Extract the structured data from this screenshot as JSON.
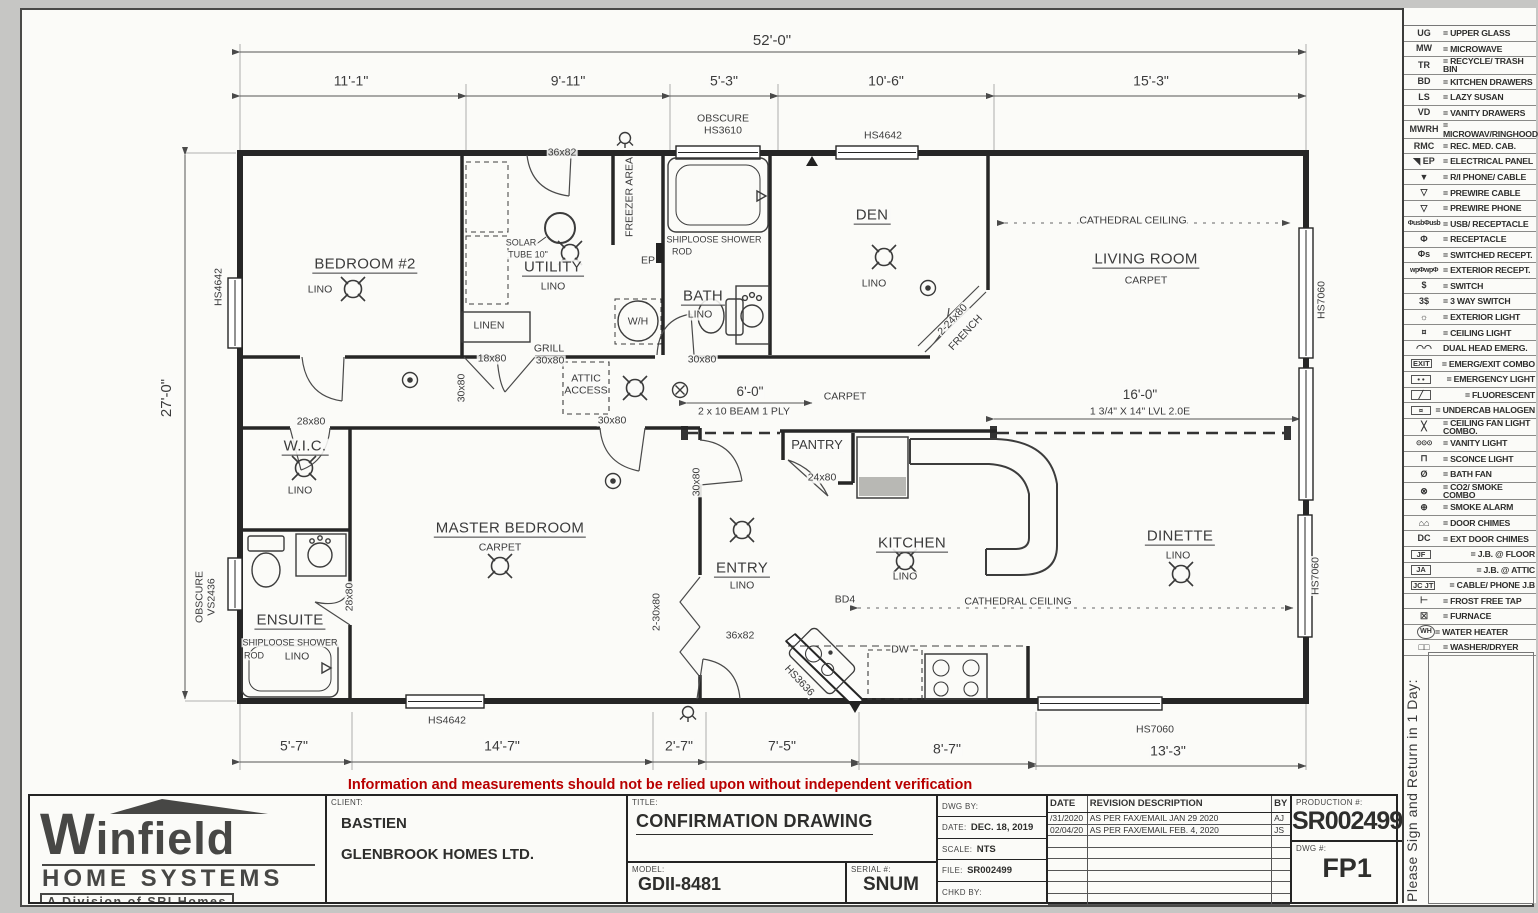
{
  "disclaimer": "Information and measurements should not be relied upon without independent verification",
  "sign_notice": "Please Sign and Return in 1 Day:",
  "legend": {
    "items": [
      {
        "sym": "UG",
        "label": "= UPPER GLASS",
        "icon": "upper-glass"
      },
      {
        "sym": "MW",
        "label": "= MICROWAVE",
        "icon": "microwave"
      },
      {
        "sym": "TR",
        "label": "= RECYCLE/ TRASH BIN",
        "icon": "recycle-trash-bin"
      },
      {
        "sym": "BD",
        "label": "= KITCHEN DRAWERS",
        "icon": "kitchen-drawers"
      },
      {
        "sym": "LS",
        "label": "= LAZY SUSAN",
        "icon": "lazy-susan"
      },
      {
        "sym": "VD",
        "label": "= VANITY DRAWERS",
        "icon": "vanity-drawers"
      },
      {
        "sym": "MWRH",
        "label": "= MICROWAV/RINGHOOD",
        "icon": "microwave-rangehood"
      },
      {
        "sym": "RMC",
        "label": "= REC. MED. CAB.",
        "icon": "recessed-medicine-cabinet"
      },
      {
        "sym": "◥ EP",
        "label": "= ELECTRICAL PANEL",
        "icon": "electrical-panel"
      },
      {
        "sym": "▼",
        "label": "= R/I PHONE/ CABLE",
        "icon": "phone-cable-rough-in"
      },
      {
        "sym": "▽",
        "label": "= PREWIRE CABLE",
        "icon": "prewire-cable"
      },
      {
        "sym": "▽",
        "label": "= PREWIRE PHONE",
        "icon": "prewire-phone"
      },
      {
        "sym": "ΦusbΦusb",
        "label": "= USB/ RECEPTACLE",
        "icon": "usb-receptacle",
        "style": "tiny"
      },
      {
        "sym": "Φ",
        "label": "= RECEPTACLE",
        "icon": "receptacle"
      },
      {
        "sym": "Φs",
        "label": "= SWITCHED RECEPT.",
        "icon": "switched-receptacle"
      },
      {
        "sym": "wpΦwpΦ",
        "label": "= EXTERIOR RECEPT.",
        "icon": "exterior-receptacle",
        "style": "tiny"
      },
      {
        "sym": "$",
        "label": "= SWITCH",
        "icon": "switch"
      },
      {
        "sym": "3$",
        "label": "= 3 WAY SWITCH",
        "icon": "three-way-switch"
      },
      {
        "sym": "☼",
        "label": "= EXTERIOR LIGHT",
        "icon": "exterior-light"
      },
      {
        "sym": "¤",
        "label": "= CEILING LIGHT",
        "icon": "ceiling-light"
      },
      {
        "sym": "◠◠",
        "label": "DUAL HEAD EMERG.",
        "icon": "dual-head-emergency-light"
      },
      {
        "sym": "EXIT",
        "label": "= EMERG/EXIT COMBO",
        "icon": "emergency-exit-combo",
        "style": "box"
      },
      {
        "sym": "• •",
        "label": "= EMERGENCY LIGHT",
        "icon": "emergency-light",
        "style": "box"
      },
      {
        "sym": "╱",
        "label": "= FLUORESCENT",
        "icon": "fluorescent-light",
        "style": "box"
      },
      {
        "sym": "¤",
        "label": "= UNDERCAB HALOGEN",
        "icon": "undercabinet-halogen",
        "style": "box"
      },
      {
        "sym": "╳",
        "label": "= CEILING FAN LIGHT COMBO.",
        "icon": "ceiling-fan-light-combo"
      },
      {
        "sym": "⊙⊙⊙",
        "label": "= VANITY LIGHT",
        "icon": "vanity-light",
        "style": "tiny"
      },
      {
        "sym": "⊓",
        "label": "= SCONCE LIGHT",
        "icon": "sconce-light"
      },
      {
        "sym": "Ø",
        "label": "= BATH FAN",
        "icon": "bath-fan"
      },
      {
        "sym": "⊗",
        "label": "= CO2/ SMOKE COMBO",
        "icon": "co2-smoke-combo"
      },
      {
        "sym": "⊕",
        "label": "= SMOKE ALARM",
        "icon": "smoke-alarm"
      },
      {
        "sym": "⌂⌂",
        "label": "= DOOR CHIMES",
        "icon": "door-chimes"
      },
      {
        "sym": "DC",
        "label": "= EXT DOOR CHIMES",
        "icon": "exterior-door-chimes"
      },
      {
        "sym": "JF",
        "label": "= J.B. @ FLOOR",
        "icon": "junction-box-floor",
        "style": "box"
      },
      {
        "sym": "JA",
        "label": "= J.B. @ ATTIC",
        "icon": "junction-box-attic",
        "style": "box"
      },
      {
        "sym": "JC JT",
        "label": "= CABLE/ PHONE J.B",
        "icon": "cable-phone-junction-box",
        "style": "box"
      },
      {
        "sym": "⊢",
        "label": "= FROST FREE TAP",
        "icon": "frost-free-tap"
      },
      {
        "sym": "☒",
        "label": "= FURNACE",
        "icon": "furnace"
      },
      {
        "sym": "WH",
        "label": "= WATER HEATER",
        "icon": "water-heater",
        "style": "circle"
      },
      {
        "sym": "□□",
        "label": "= WASHER/DRYER",
        "icon": "washer-dryer"
      }
    ]
  },
  "title_block": {
    "logo_name": "Winfield",
    "logo_line2": "HOME SYSTEMS",
    "logo_line3": "A Division of SRI Homes",
    "client_label": "CLIENT:",
    "client_name": "BASTIEN",
    "client_company": "GLENBROOK HOMES LTD.",
    "title_label": "TITLE:",
    "title": "CONFIRMATION DRAWING",
    "model_label": "MODEL:",
    "model": "GDII-8481",
    "serial_label": "SERIAL #:",
    "serial": "SNUM",
    "dwg_by_label": "DWG BY:",
    "dwg_by": "JSIOPONGCO",
    "date_label": "DATE:",
    "date": "DEC. 18, 2019",
    "scale_label": "SCALE:",
    "scale": "NTS",
    "file_label": "FILE:",
    "file": "SR002499",
    "chkd_label": "CHKD BY:",
    "revisions": {
      "headers": [
        "DATE",
        "REVISION DESCRIPTION",
        "BY"
      ],
      "rows": [
        [
          "/31/2020",
          "AS PER FAX/EMAIL  JAN 29 2020",
          "AJ"
        ],
        [
          "02/04/20",
          "AS PER FAX/EMAIL  FEB. 4, 2020",
          "JS"
        ]
      ]
    },
    "production_label": "PRODUCTION #:",
    "production": "SR002499",
    "dwg_no_label": "DWG #:",
    "dwg_no": "FP1"
  },
  "plan": {
    "dimensions": {
      "overall_width": "52'-0\"",
      "overall_depth": "27'-0\"",
      "top": [
        "11'-1\"",
        "9'-11\"",
        "5'-3\"",
        "10'-6\"",
        "15'-3\""
      ],
      "bottom": [
        "5'-7\"",
        "14'-7\"",
        "2'-7\"",
        "7'-5\"",
        "8'-7\"",
        "13'-3\""
      ]
    },
    "rooms": [
      {
        "name": "BEDROOM #2",
        "floor": "LINO"
      },
      {
        "name": "UTILITY",
        "floor": "LINO"
      },
      {
        "name": "BATH",
        "floor": "LINO"
      },
      {
        "name": "DEN",
        "floor": "LINO"
      },
      {
        "name": "LIVING ROOM",
        "floor": "CARPET"
      },
      {
        "name": "W.I.C.",
        "floor": "LINO"
      },
      {
        "name": "MASTER BEDROOM",
        "floor": "CARPET"
      },
      {
        "name": "ENSUITE",
        "floor": "LINO"
      },
      {
        "name": "ENTRY",
        "floor": "LINO"
      },
      {
        "name": "KITCHEN",
        "floor": "LINO"
      },
      {
        "name": "DINETTE",
        "floor": "LINO"
      },
      {
        "name": "PANTRY",
        "floor": ""
      }
    ],
    "labels": [
      {
        "t": "52'-0\"",
        "x": 772,
        "y": 41,
        "c": "dimL",
        "n": "dim-top-overall"
      },
      {
        "t": "11'-1\"",
        "x": 351,
        "y": 81,
        "c": "dim"
      },
      {
        "t": "9'-11\"",
        "x": 568,
        "y": 81,
        "c": "dim"
      },
      {
        "t": "5'-3\"",
        "x": 724,
        "y": 81,
        "c": "dim"
      },
      {
        "t": "10'-6\"",
        "x": 886,
        "y": 81,
        "c": "dim"
      },
      {
        "t": "15'-3\"",
        "x": 1151,
        "y": 81,
        "c": "dim"
      },
      {
        "t": "27'-0\"",
        "x": 167,
        "y": 398,
        "c": "dimL",
        "r": -90,
        "n": "dim-left-overall"
      },
      {
        "t": "5'-7\"",
        "x": 294,
        "y": 746,
        "c": "dim"
      },
      {
        "t": "14'-7\"",
        "x": 502,
        "y": 746,
        "c": "dim"
      },
      {
        "t": "2'-7\"",
        "x": 679,
        "y": 746,
        "c": "dim"
      },
      {
        "t": "7'-5\"",
        "x": 782,
        "y": 746,
        "c": "dim"
      },
      {
        "t": "8'-7\"",
        "x": 947,
        "y": 749,
        "c": "dim"
      },
      {
        "t": "13'-3\"",
        "x": 1168,
        "y": 751,
        "c": "dim"
      },
      {
        "t": "6'-0\"",
        "x": 750,
        "y": 392,
        "c": "dim2"
      },
      {
        "t": "2 x 10 BEAM 1 PLY",
        "x": 744,
        "y": 412,
        "c": "sm"
      },
      {
        "t": "16'-0\"",
        "x": 1140,
        "y": 395,
        "c": "dim2"
      },
      {
        "t": "1 3/4\" X 14\" LVL 2.0E",
        "x": 1140,
        "y": 412,
        "c": "sm"
      },
      {
        "t": "HS4642",
        "x": 219,
        "y": 287,
        "c": "sm",
        "r": -90
      },
      {
        "t": "OBSCURE",
        "x": 723,
        "y": 119,
        "c": "sm"
      },
      {
        "t": "HS3610",
        "x": 723,
        "y": 131,
        "c": "sm"
      },
      {
        "t": "HS4642",
        "x": 883,
        "y": 136,
        "c": "sm"
      },
      {
        "t": "HS7060",
        "x": 1322,
        "y": 300,
        "c": "sm",
        "r": -90
      },
      {
        "t": "HS7060",
        "x": 1316,
        "y": 576,
        "c": "sm",
        "r": -90
      },
      {
        "t": "OBSCURE",
        "x": 200,
        "y": 597,
        "c": "sm",
        "r": -90
      },
      {
        "t": "VS2436",
        "x": 212,
        "y": 597,
        "c": "sm",
        "r": -90
      },
      {
        "t": "HS3636",
        "x": 799,
        "y": 681,
        "c": "sm",
        "r": 47
      },
      {
        "t": "HS4642",
        "x": 447,
        "y": 721,
        "c": "sm"
      },
      {
        "t": "HS7060",
        "x": 1155,
        "y": 730,
        "c": "sm"
      },
      {
        "t": "36x82",
        "x": 562,
        "y": 153,
        "c": "sm"
      },
      {
        "t": "36x82",
        "x": 740,
        "y": 636,
        "c": "sm"
      },
      {
        "t": "28x80",
        "x": 311,
        "y": 422,
        "c": "sm"
      },
      {
        "t": "28x80",
        "x": 350,
        "y": 597,
        "c": "sm",
        "r": -90
      },
      {
        "t": "30x80",
        "x": 612,
        "y": 421,
        "c": "sm"
      },
      {
        "t": "30x80",
        "x": 697,
        "y": 482,
        "c": "sm",
        "r": -90
      },
      {
        "t": "30x80",
        "x": 702,
        "y": 360,
        "c": "sm"
      },
      {
        "t": "30x80",
        "x": 462,
        "y": 388,
        "c": "sm",
        "r": -90
      },
      {
        "t": "GRILL",
        "x": 549,
        "y": 349,
        "c": "sm"
      },
      {
        "t": "30x80",
        "x": 550,
        "y": 361,
        "c": "sm"
      },
      {
        "t": "18x80",
        "x": 492,
        "y": 359,
        "c": "sm"
      },
      {
        "t": "24x80",
        "x": 822,
        "y": 478,
        "c": "sm"
      },
      {
        "t": "2-30x80",
        "x": 657,
        "y": 612,
        "c": "sm",
        "r": -90
      },
      {
        "t": "2-24x80",
        "x": 953,
        "y": 320,
        "c": "sm",
        "r": -47
      },
      {
        "t": "FRENCH",
        "x": 966,
        "y": 333,
        "c": "sm",
        "r": -47
      },
      {
        "t": "BEDROOM #2",
        "x": 365,
        "y": 265,
        "c": "rt",
        "n": "room-bedroom2"
      },
      {
        "t": "LINO",
        "x": 320,
        "y": 290,
        "c": "sm"
      },
      {
        "t": "UTILITY",
        "x": 553,
        "y": 268,
        "c": "rt",
        "n": "room-utility"
      },
      {
        "t": "LINO",
        "x": 553,
        "y": 287,
        "c": "sm"
      },
      {
        "t": "BATH",
        "x": 703,
        "y": 297,
        "c": "rt",
        "n": "room-bath"
      },
      {
        "t": "LINO",
        "x": 700,
        "y": 315,
        "c": "sm"
      },
      {
        "t": "DEN",
        "x": 872,
        "y": 216,
        "c": "rt",
        "n": "room-den"
      },
      {
        "t": "LINO",
        "x": 874,
        "y": 284,
        "c": "sm"
      },
      {
        "t": "LIVING ROOM",
        "x": 1146,
        "y": 260,
        "c": "rt",
        "n": "room-living-room"
      },
      {
        "t": "CARPET",
        "x": 1146,
        "y": 281,
        "c": "sm"
      },
      {
        "t": "W.I.C.",
        "x": 305,
        "y": 447,
        "c": "rt",
        "n": "room-wic"
      },
      {
        "t": "LINO",
        "x": 300,
        "y": 491,
        "c": "sm"
      },
      {
        "t": "MASTER BEDROOM",
        "x": 510,
        "y": 529,
        "c": "rt",
        "n": "room-master-bedroom"
      },
      {
        "t": "CARPET",
        "x": 500,
        "y": 548,
        "c": "sm"
      },
      {
        "t": "ENSUITE",
        "x": 290,
        "y": 621,
        "c": "rt",
        "n": "room-ensuite"
      },
      {
        "t": "SHIPLOOSE SHOWER",
        "x": 290,
        "y": 643,
        "c": "xs"
      },
      {
        "t": "ROD",
        "x": 254,
        "y": 656,
        "c": "xs"
      },
      {
        "t": "LINO",
        "x": 297,
        "y": 657,
        "c": "sm"
      },
      {
        "t": "ENTRY",
        "x": 742,
        "y": 569,
        "c": "rt",
        "n": "room-entry"
      },
      {
        "t": "LINO",
        "x": 742,
        "y": 586,
        "c": "sm"
      },
      {
        "t": "KITCHEN",
        "x": 912,
        "y": 544,
        "c": "rt",
        "n": "room-kitchen"
      },
      {
        "t": "LINO",
        "x": 905,
        "y": 577,
        "c": "sm"
      },
      {
        "t": "DINETTE",
        "x": 1180,
        "y": 537,
        "c": "rt",
        "n": "room-dinette"
      },
      {
        "t": "LINO",
        "x": 1178,
        "y": 556,
        "c": "sm"
      },
      {
        "t": "PANTRY",
        "x": 817,
        "y": 445,
        "c": "md",
        "n": "room-pantry"
      },
      {
        "t": "SHIPLOOSE SHOWER",
        "x": 714,
        "y": 240,
        "c": "xs"
      },
      {
        "t": "ROD",
        "x": 682,
        "y": 252,
        "c": "xs"
      },
      {
        "t": "SOLAR",
        "x": 521,
        "y": 243,
        "c": "xs"
      },
      {
        "t": "TUBE 10\"",
        "x": 528,
        "y": 255,
        "c": "xs"
      },
      {
        "t": "LINEN",
        "x": 489,
        "y": 326,
        "c": "sm"
      },
      {
        "t": "W/H",
        "x": 638,
        "y": 322,
        "c": "sm"
      },
      {
        "t": "FREEZER AREA",
        "x": 630,
        "y": 197,
        "c": "sm",
        "r": -90
      },
      {
        "t": "EP",
        "x": 648,
        "y": 261,
        "c": "sm"
      },
      {
        "t": "ATTIC",
        "x": 586,
        "y": 379,
        "c": "sm"
      },
      {
        "t": "ACCESS",
        "x": 586,
        "y": 391,
        "c": "sm"
      },
      {
        "t": "CARPET",
        "x": 845,
        "y": 397,
        "c": "sm"
      },
      {
        "t": "CATHEDRAL CEILING",
        "x": 1133,
        "y": 221,
        "c": "sm"
      },
      {
        "t": "CATHEDRAL CEILING",
        "x": 1018,
        "y": 602,
        "c": "sm"
      },
      {
        "t": "BD4",
        "x": 845,
        "y": 600,
        "c": "sm"
      },
      {
        "t": "DW",
        "x": 900,
        "y": 650,
        "c": "sm"
      }
    ]
  }
}
